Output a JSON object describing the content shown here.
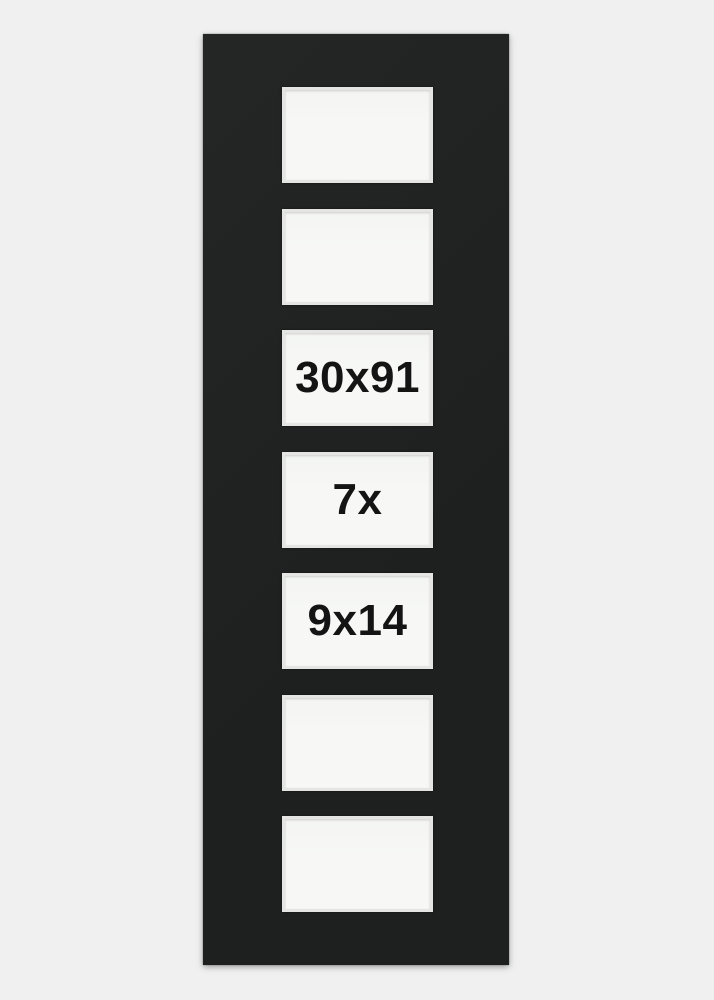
{
  "colors": {
    "bg": "#eff0ef",
    "mat": "#202222",
    "opening": "#f7f8f6",
    "bevel": "#e5e6e4",
    "label": "#141414"
  },
  "openings": [
    {
      "label": ""
    },
    {
      "label": ""
    },
    {
      "label": "30x91"
    },
    {
      "label": "7x"
    },
    {
      "label": "9x14"
    },
    {
      "label": ""
    },
    {
      "label": ""
    }
  ]
}
